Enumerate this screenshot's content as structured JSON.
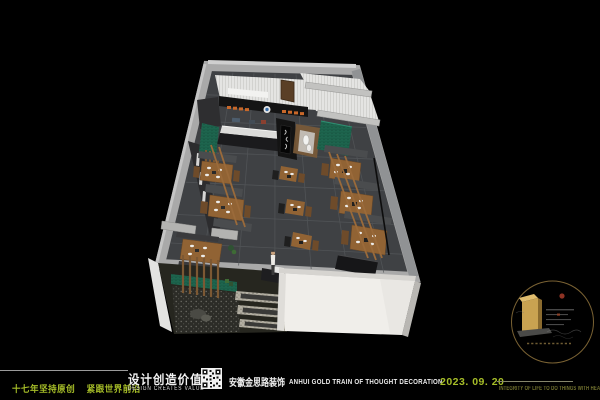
{
  "footer": {
    "slogan_part1": "十七年坚持原创",
    "slogan_part2": "紧跟世界前沿",
    "brand_cn": "设计创造价值",
    "brand_en": "DESIGN CREATES VALUE",
    "company_cn": "安徽金思路装饰",
    "company_en": "ANHUI GOLD TRAIN OF THOUGHT DECORATION",
    "date": "2023. 09. 20",
    "motto": "INTEGRITY OF LIFE TO DO THINGS WITH HEART"
  },
  "emblem": {
    "shape": "circular-gold-seal",
    "elements": [
      "gold-gate-monument",
      "red-sun-dot",
      "cloud-motif",
      "faint-text-rows"
    ]
  },
  "scene": {
    "subject": "3d-birdseye-restaurant-floorplan-rendering"
  },
  "colors": {
    "accent_yellow_green": "#a6bd28",
    "motto_olive": "#73732f",
    "wall_gray": "#a9a9a9",
    "floor_charcoal": "#3f4144",
    "wood_brown": "#916334",
    "tile_teal": "#1f6b52",
    "sign_orange": "#c8682a",
    "facade_white": "#f0eeea",
    "emblem_gold": "#c9a251"
  }
}
